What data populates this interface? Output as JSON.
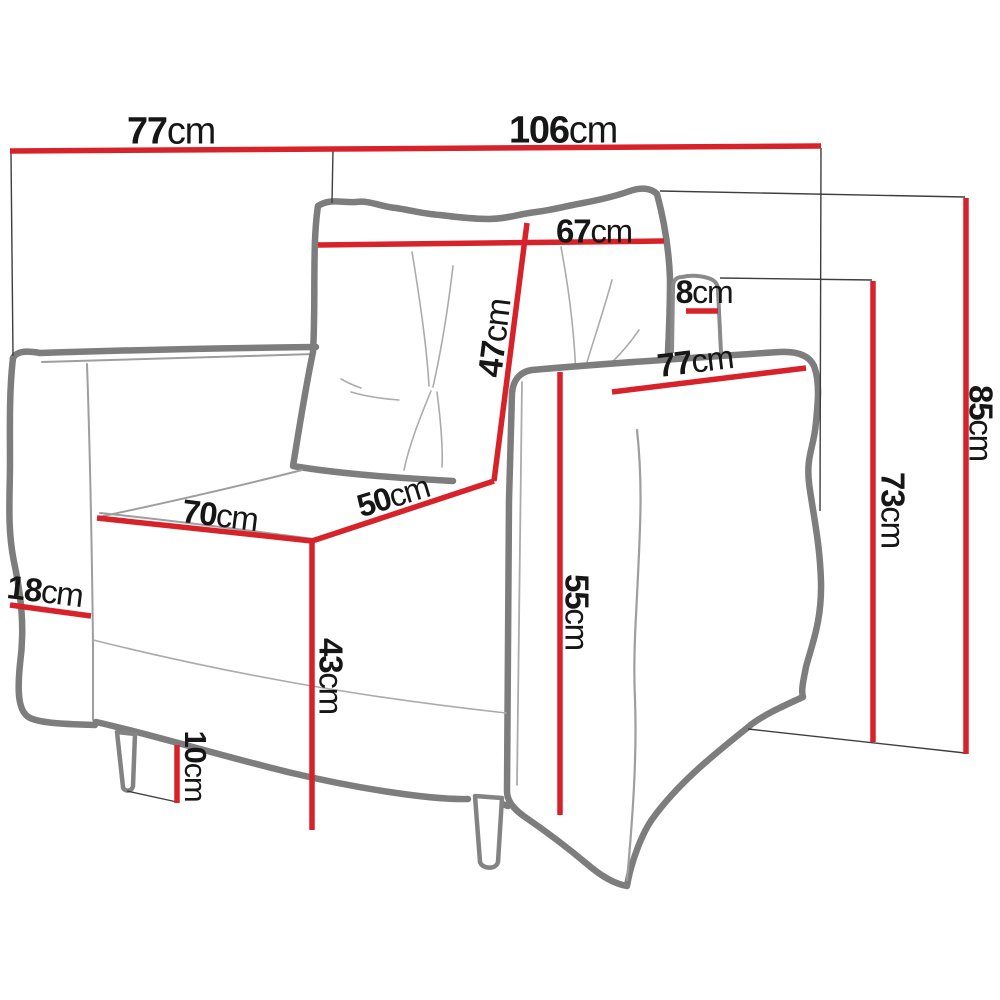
{
  "page": {
    "description": "Armchair technical dimensions diagram",
    "background": "#ffffff"
  },
  "colors": {
    "dimension_line": "#d7222a",
    "extension_line": "#3e3e3e",
    "outline": "#7d7d7d",
    "text": "#161616"
  },
  "unit": "cm",
  "dimensions": [
    {
      "name": "back-width-77",
      "value": "77",
      "unit": "cm",
      "label": {
        "x": 171,
        "y": 130,
        "size": 38,
        "rotate": 0
      },
      "line": {
        "x1": 10,
        "y1": 151,
        "x2": 333,
        "y2": 149
      }
    },
    {
      "name": "total-width-106",
      "value": "106",
      "unit": "cm",
      "label": {
        "x": 563,
        "y": 129,
        "size": 38,
        "rotate": 0
      },
      "line": {
        "x1": 333,
        "y1": 149,
        "x2": 821,
        "y2": 146
      }
    },
    {
      "name": "cushion-width-67",
      "value": "67",
      "unit": "cm",
      "label": {
        "x": 594,
        "y": 231,
        "size": 33,
        "rotate": 0
      },
      "line": {
        "x1": 318,
        "y1": 245,
        "x2": 664,
        "y2": 241
      }
    },
    {
      "name": "cushion-height-47",
      "value": "47",
      "unit": "cm",
      "label": {
        "x": 494,
        "y": 338,
        "size": 34,
        "rotate": -83
      },
      "line": {
        "x1": 527,
        "y1": 223,
        "x2": 494,
        "y2": 481
      }
    },
    {
      "name": "headrest-depth-8",
      "value": "8",
      "unit": "cm",
      "label": {
        "x": 704,
        "y": 292,
        "size": 32,
        "rotate": 0
      },
      "line": {
        "x1": 686,
        "y1": 311,
        "x2": 718,
        "y2": 311
      }
    },
    {
      "name": "armrest-length-77",
      "value": "77",
      "unit": "cm",
      "label": {
        "x": 695,
        "y": 361,
        "size": 33,
        "rotate": -7
      },
      "line": {
        "x1": 612,
        "y1": 392,
        "x2": 806,
        "y2": 368
      }
    },
    {
      "name": "seat-width-70",
      "value": "70",
      "unit": "cm",
      "label": {
        "x": 220,
        "y": 515,
        "size": 33,
        "rotate": 7
      },
      "line": {
        "x1": 97,
        "y1": 518,
        "x2": 312,
        "y2": 541
      }
    },
    {
      "name": "seat-depth-50",
      "value": "50",
      "unit": "cm",
      "label": {
        "x": 393,
        "y": 496,
        "size": 32,
        "rotate": -17
      },
      "line": {
        "x1": 312,
        "y1": 541,
        "x2": 494,
        "y2": 481
      }
    },
    {
      "name": "seat-height-43",
      "value": "43",
      "unit": "cm",
      "label": {
        "x": 331,
        "y": 676,
        "size": 33,
        "rotate": 90
      },
      "line": {
        "x1": 312,
        "y1": 541,
        "x2": 312,
        "y2": 830
      }
    },
    {
      "name": "armrest-width-18",
      "value": "18",
      "unit": "cm",
      "label": {
        "x": 45,
        "y": 591,
        "size": 33,
        "rotate": 7
      },
      "line": {
        "x1": 10,
        "y1": 605,
        "x2": 91,
        "y2": 616
      }
    },
    {
      "name": "leg-height-10",
      "value": "10",
      "unit": "cm",
      "label": {
        "x": 196,
        "y": 766,
        "size": 31,
        "rotate": 90
      },
      "line": {
        "x1": 177,
        "y1": 745,
        "x2": 177,
        "y2": 803
      }
    },
    {
      "name": "side-front-height-55",
      "value": "55",
      "unit": "cm",
      "label": {
        "x": 577,
        "y": 612,
        "size": 33,
        "rotate": 90
      },
      "line": {
        "x1": 560,
        "y1": 372,
        "x2": 560,
        "y2": 815
      }
    },
    {
      "name": "backrest-height-73",
      "value": "73",
      "unit": "cm",
      "label": {
        "x": 893,
        "y": 510,
        "size": 33,
        "rotate": 90
      },
      "line": {
        "x1": 873,
        "y1": 281,
        "x2": 873,
        "y2": 742
      }
    },
    {
      "name": "total-height-85",
      "value": "85",
      "unit": "cm",
      "label": {
        "x": 981,
        "y": 423,
        "size": 33,
        "rotate": 90
      },
      "line": {
        "x1": 966,
        "y1": 198,
        "x2": 966,
        "y2": 754
      }
    }
  ],
  "extension_lines": [
    {
      "x1": 11,
      "y1": 153,
      "x2": 13,
      "y2": 356
    },
    {
      "x1": 333,
      "y1": 149,
      "x2": 332,
      "y2": 203
    },
    {
      "x1": 821,
      "y1": 148,
      "x2": 820,
      "y2": 511
    },
    {
      "x1": 660,
      "y1": 191,
      "x2": 965,
      "y2": 197
    },
    {
      "x1": 720,
      "y1": 278,
      "x2": 872,
      "y2": 280
    },
    {
      "x1": 748,
      "y1": 729,
      "x2": 965,
      "y2": 753
    },
    {
      "x1": 127,
      "y1": 791,
      "x2": 177,
      "y2": 802
    }
  ]
}
